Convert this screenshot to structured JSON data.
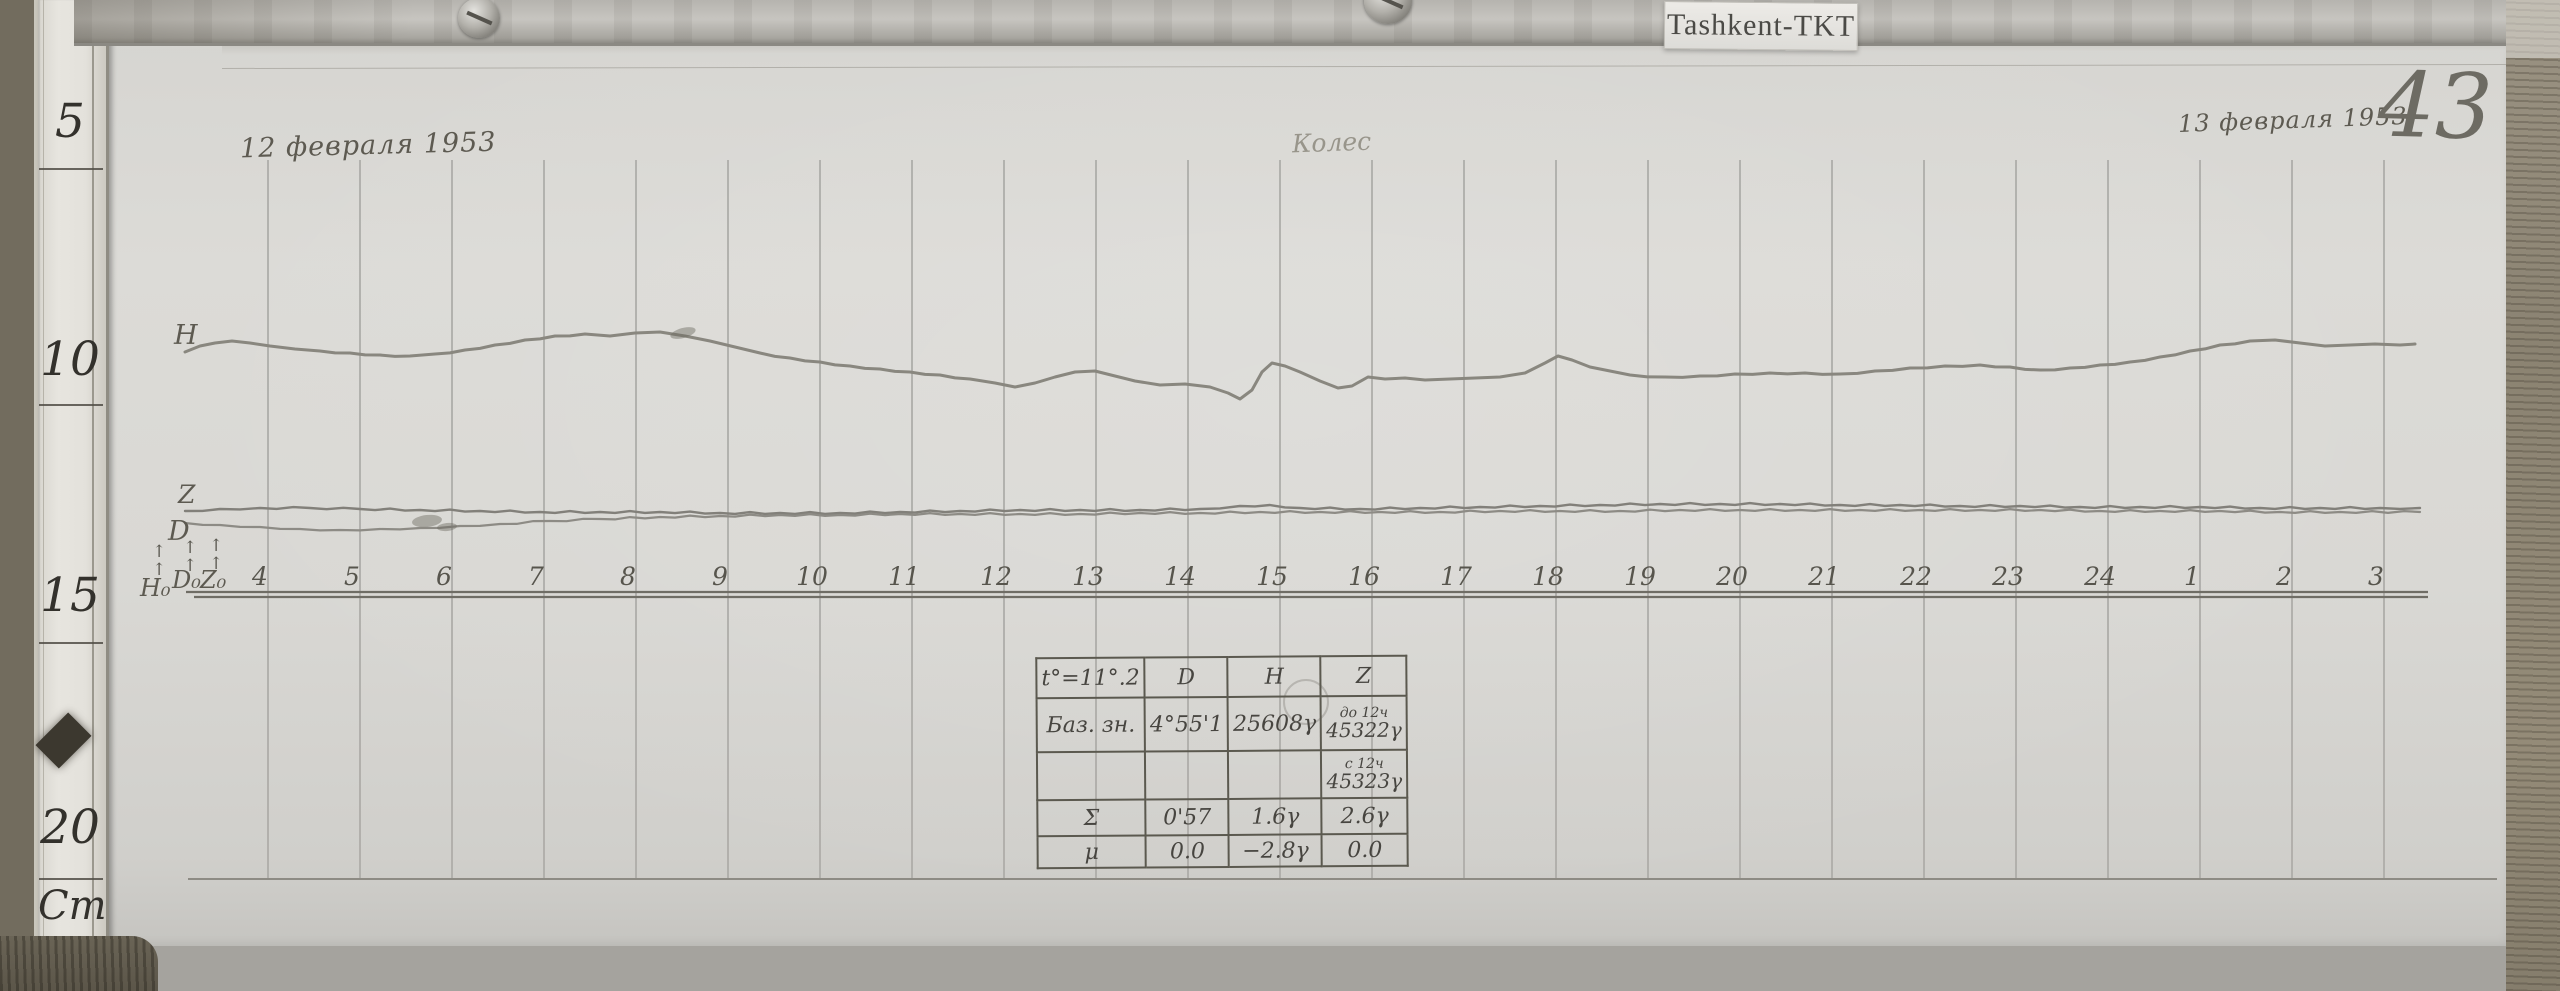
{
  "station_label": "Tashkent-TKT",
  "page_number": "43",
  "date_left": "12 февраля 1953",
  "date_right": "13 февраля 1953",
  "signature": "Колес",
  "ruler": {
    "labels": [
      "5",
      "10",
      "15",
      "20",
      "Cm"
    ]
  },
  "trace_labels": {
    "h": "H",
    "z": "Z",
    "d": "D",
    "h0": "H₀",
    "d0": "D₀",
    "z0": "Z₀",
    "arrow": "↑"
  },
  "obs_table": {
    "header": [
      "t°=11°.2",
      "D",
      "H",
      "Z"
    ],
    "base_row_label": "Баз. зн.",
    "base_d": "4°55'1",
    "base_h": "25608γ",
    "base_z1_note": "до 12ч",
    "base_z1": "45322γ",
    "base_z2_note": "с 12ч",
    "base_z2": "45323γ",
    "sigma_label": "Σ",
    "sigma_d": "0'57",
    "sigma_h": "1.6γ",
    "sigma_z": "2.6γ",
    "mu_label": "μ",
    "mu_d": "0.0",
    "mu_h": "−2.8γ",
    "mu_z": "0.0"
  },
  "chart_data": {
    "type": "line",
    "title": "Magnetogram, observatory Tashkent-TKT, 12–13 February 1953, sheet 43",
    "xlabel": "time, hours (4h of 12 Feb through 3h of 13 Feb)",
    "ylabel": "trace deflection (photographic paper, cm ruler at left: 5–20 Cm)",
    "x_tick_labels": [
      "4",
      "5",
      "6",
      "7",
      "8",
      "9",
      "10",
      "11",
      "12",
      "13",
      "14",
      "15",
      "16",
      "17",
      "18",
      "19",
      "20",
      "21",
      "22",
      "23",
      "24",
      "1",
      "2",
      "3"
    ],
    "legend": [
      "H (horizontal intensity)",
      "Z (vertical intensity)",
      "D (declination)"
    ],
    "layout": {
      "x_first_px": 260,
      "x_spacing_px": 92,
      "grid_x_offset_px": 8,
      "grid_top_px": 160,
      "baseline_y_px": 592,
      "baseline_y2_px": 597,
      "bottom_line_y_px": 879,
      "axis_x_start_px": 186,
      "axis_x_end_px": 2428,
      "bottom_x_start_px": 188,
      "bottom_x_end_px": 2497
    },
    "series": [
      {
        "name": "H",
        "points": [
          [
            185,
            352
          ],
          [
            200,
            346
          ],
          [
            215,
            343
          ],
          [
            232,
            341
          ],
          [
            250,
            343
          ],
          [
            270,
            346
          ],
          [
            295,
            349
          ],
          [
            320,
            351
          ],
          [
            350,
            353
          ],
          [
            380,
            355
          ],
          [
            410,
            356
          ],
          [
            435,
            354
          ],
          [
            465,
            350
          ],
          [
            495,
            345
          ],
          [
            525,
            340
          ],
          [
            555,
            336
          ],
          [
            585,
            334
          ],
          [
            610,
            336
          ],
          [
            635,
            333
          ],
          [
            660,
            332
          ],
          [
            685,
            336
          ],
          [
            710,
            341
          ],
          [
            735,
            347
          ],
          [
            760,
            353
          ],
          [
            790,
            358
          ],
          [
            820,
            362
          ],
          [
            850,
            366
          ],
          [
            880,
            369
          ],
          [
            910,
            372
          ],
          [
            940,
            375
          ],
          [
            970,
            379
          ],
          [
            995,
            383
          ],
          [
            1015,
            387
          ],
          [
            1035,
            383
          ],
          [
            1055,
            377
          ],
          [
            1075,
            372
          ],
          [
            1095,
            371
          ],
          [
            1115,
            376
          ],
          [
            1135,
            381
          ],
          [
            1160,
            385
          ],
          [
            1185,
            384
          ],
          [
            1210,
            387
          ],
          [
            1228,
            393
          ],
          [
            1240,
            399
          ],
          [
            1252,
            390
          ],
          [
            1262,
            372
          ],
          [
            1272,
            363
          ],
          [
            1285,
            366
          ],
          [
            1300,
            372
          ],
          [
            1320,
            381
          ],
          [
            1338,
            388
          ],
          [
            1352,
            386
          ],
          [
            1368,
            377
          ],
          [
            1385,
            379
          ],
          [
            1405,
            378
          ],
          [
            1425,
            380
          ],
          [
            1450,
            379
          ],
          [
            1475,
            378
          ],
          [
            1500,
            377
          ],
          [
            1525,
            373
          ],
          [
            1545,
            363
          ],
          [
            1558,
            356
          ],
          [
            1572,
            360
          ],
          [
            1590,
            367
          ],
          [
            1610,
            371
          ],
          [
            1630,
            375
          ],
          [
            1665,
            377
          ],
          [
            1700,
            376
          ],
          [
            1735,
            374
          ],
          [
            1770,
            373
          ],
          [
            1805,
            373
          ],
          [
            1840,
            374
          ],
          [
            1875,
            371
          ],
          [
            1910,
            368
          ],
          [
            1945,
            366
          ],
          [
            1980,
            365
          ],
          [
            2010,
            367
          ],
          [
            2040,
            370
          ],
          [
            2070,
            368
          ],
          [
            2100,
            365
          ],
          [
            2130,
            362
          ],
          [
            2160,
            357
          ],
          [
            2190,
            351
          ],
          [
            2220,
            345
          ],
          [
            2250,
            341
          ],
          [
            2275,
            340
          ],
          [
            2300,
            343
          ],
          [
            2325,
            346
          ],
          [
            2350,
            345
          ],
          [
            2375,
            344
          ],
          [
            2400,
            345
          ],
          [
            2415,
            344
          ]
        ]
      },
      {
        "name": "Z",
        "points": [
          [
            185,
            511
          ],
          [
            220,
            509
          ],
          [
            260,
            508
          ],
          [
            310,
            508
          ],
          [
            360,
            509
          ],
          [
            420,
            510
          ],
          [
            480,
            511
          ],
          [
            540,
            512
          ],
          [
            600,
            512
          ],
          [
            660,
            512
          ],
          [
            720,
            513
          ],
          [
            780,
            513
          ],
          [
            840,
            513
          ],
          [
            900,
            512
          ],
          [
            960,
            511
          ],
          [
            1020,
            510
          ],
          [
            1080,
            510
          ],
          [
            1140,
            510
          ],
          [
            1200,
            509
          ],
          [
            1240,
            506
          ],
          [
            1270,
            505
          ],
          [
            1300,
            508
          ],
          [
            1360,
            509
          ],
          [
            1420,
            508
          ],
          [
            1480,
            507
          ],
          [
            1540,
            506
          ],
          [
            1600,
            505
          ],
          [
            1660,
            504
          ],
          [
            1720,
            504
          ],
          [
            1780,
            504
          ],
          [
            1840,
            505
          ],
          [
            1900,
            505
          ],
          [
            1960,
            506
          ],
          [
            2020,
            506
          ],
          [
            2080,
            507
          ],
          [
            2140,
            507
          ],
          [
            2200,
            507
          ],
          [
            2260,
            508
          ],
          [
            2320,
            508
          ],
          [
            2380,
            508
          ],
          [
            2420,
            508
          ]
        ]
      },
      {
        "name": "D",
        "points": [
          [
            185,
            523
          ],
          [
            220,
            525
          ],
          [
            260,
            527
          ],
          [
            300,
            529
          ],
          [
            340,
            530
          ],
          [
            380,
            529
          ],
          [
            420,
            528
          ],
          [
            460,
            526
          ],
          [
            500,
            524
          ],
          [
            550,
            521
          ],
          [
            600,
            519
          ],
          [
            660,
            517
          ],
          [
            720,
            516
          ],
          [
            780,
            515
          ],
          [
            840,
            515
          ],
          [
            900,
            514
          ],
          [
            960,
            514
          ],
          [
            1020,
            514
          ],
          [
            1080,
            514
          ],
          [
            1140,
            513
          ],
          [
            1200,
            513
          ],
          [
            1260,
            512
          ],
          [
            1320,
            512
          ],
          [
            1380,
            512
          ],
          [
            1440,
            512
          ],
          [
            1500,
            511
          ],
          [
            1560,
            511
          ],
          [
            1620,
            511
          ],
          [
            1680,
            510
          ],
          [
            1740,
            510
          ],
          [
            1800,
            510
          ],
          [
            1860,
            510
          ],
          [
            1920,
            510
          ],
          [
            1980,
            510
          ],
          [
            2040,
            510
          ],
          [
            2100,
            511
          ],
          [
            2160,
            511
          ],
          [
            2220,
            511
          ],
          [
            2280,
            512
          ],
          [
            2340,
            512
          ],
          [
            2420,
            512
          ]
        ]
      }
    ],
    "smudges": [
      {
        "x": 683,
        "y": 333,
        "rx": 13,
        "ry": 5,
        "rot": -15
      },
      {
        "x": 427,
        "y": 521,
        "rx": 15,
        "ry": 6,
        "rot": -6
      },
      {
        "x": 447,
        "y": 527,
        "rx": 10,
        "ry": 4,
        "rot": -6
      }
    ],
    "doodles": [
      {
        "x": 1306,
        "y": 702,
        "r": 22
      }
    ]
  }
}
